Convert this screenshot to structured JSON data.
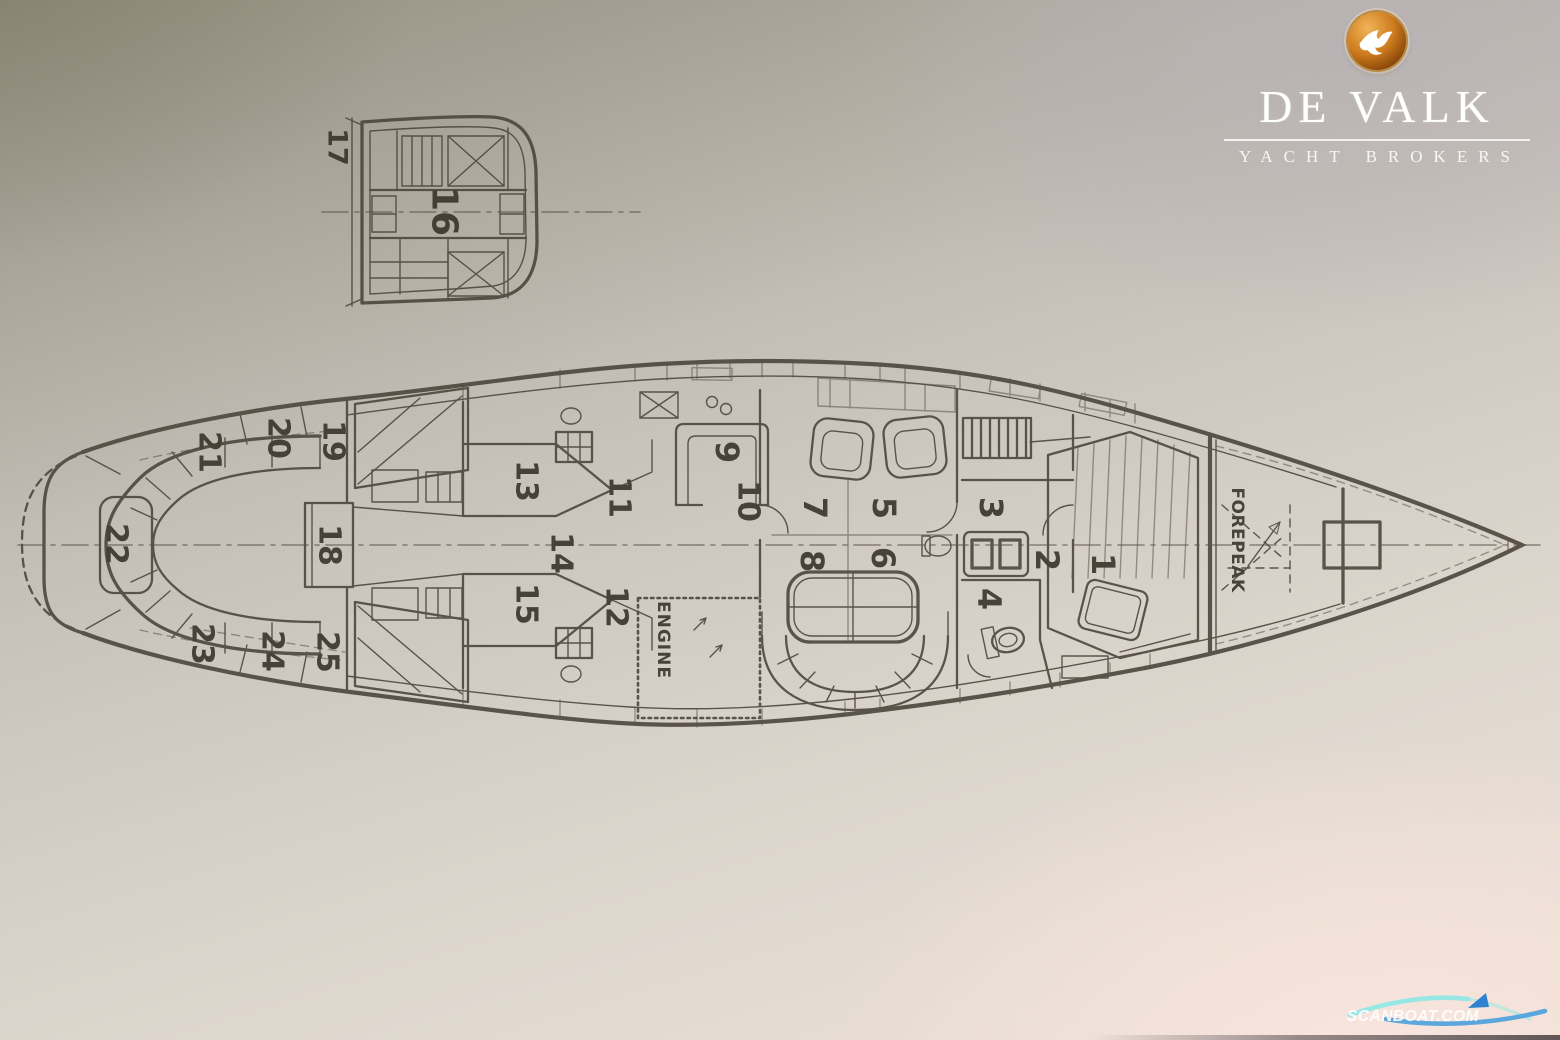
{
  "branding": {
    "title": "DE VALK",
    "tagline": "YACHT BROKERS",
    "icon": "falcon-badge-icon",
    "colors": {
      "badge_highlight": "#f2b459",
      "badge_mid": "#cd7c1e",
      "badge_dark": "#8a4709",
      "badge_rim": "#b98b45",
      "bird": "#ffffff",
      "text": "#ffffff"
    }
  },
  "watermark": {
    "text": "SCANBOAT.COM",
    "text_color": "#ffffff",
    "wave_top_color": "#86e7e6",
    "wave_bottom_color": "#4aa0dd",
    "boat_color": "#2e82d0"
  },
  "diagram": {
    "title": "sailing-yacht-accommodation-plan",
    "ink": {
      "line": "#4d463c",
      "label": "#39332a"
    },
    "paper": {
      "top_left": "#97927f",
      "center": "#ccc6bf",
      "bottom": "#e5ddd3",
      "bottom_right": "#f4e6df"
    },
    "plan_view": {
      "name": "deck-plan",
      "label_rotation_deg": 90,
      "area_labels": [
        {
          "text": "ENGINE",
          "x": 663,
          "y": 640,
          "size": 17,
          "ls": 1
        },
        {
          "text": "FOREPEAK",
          "x": 1237,
          "y": 540,
          "size": 17,
          "ls": 0.5
        }
      ],
      "compartment_labels": [
        {
          "text": "1",
          "x": 1103,
          "y": 564,
          "size": 32
        },
        {
          "text": "2",
          "x": 1047,
          "y": 560,
          "size": 32
        },
        {
          "text": "3",
          "x": 991,
          "y": 508,
          "size": 32
        },
        {
          "text": "4",
          "x": 989,
          "y": 599,
          "size": 32
        },
        {
          "text": "5",
          "x": 884,
          "y": 508,
          "size": 32
        },
        {
          "text": "6",
          "x": 883,
          "y": 558,
          "size": 32
        },
        {
          "text": "7",
          "x": 815,
          "y": 508,
          "size": 32
        },
        {
          "text": "8",
          "x": 812,
          "y": 561,
          "size": 32
        },
        {
          "text": "9",
          "x": 727,
          "y": 452,
          "size": 32
        },
        {
          "text": "10",
          "x": 748,
          "y": 501,
          "size": 30
        },
        {
          "text": "11",
          "x": 619,
          "y": 497,
          "size": 30
        },
        {
          "text": "12",
          "x": 616,
          "y": 607,
          "size": 30
        },
        {
          "text": "13",
          "x": 526,
          "y": 481,
          "size": 30
        },
        {
          "text": "14",
          "x": 561,
          "y": 553,
          "size": 30
        },
        {
          "text": "15",
          "x": 526,
          "y": 604,
          "size": 30
        },
        {
          "text": "18",
          "x": 329,
          "y": 545,
          "size": 30
        },
        {
          "text": "19",
          "x": 333,
          "y": 441,
          "size": 30
        },
        {
          "text": "20",
          "x": 278,
          "y": 438,
          "size": 30
        },
        {
          "text": "21",
          "x": 209,
          "y": 452,
          "size": 30
        },
        {
          "text": "22",
          "x": 116,
          "y": 544,
          "size": 30
        },
        {
          "text": "23",
          "x": 202,
          "y": 644,
          "size": 30
        },
        {
          "text": "24",
          "x": 272,
          "y": 651,
          "size": 30
        },
        {
          "text": "25",
          "x": 327,
          "y": 652,
          "size": 30
        }
      ]
    },
    "section_view": {
      "name": "aft-cross-section",
      "label_rotation_deg": 90,
      "labels": [
        {
          "text": "16",
          "x": 444,
          "y": 211,
          "size": 36
        },
        {
          "text": "17",
          "x": 337,
          "y": 147,
          "size": 27
        }
      ]
    }
  }
}
